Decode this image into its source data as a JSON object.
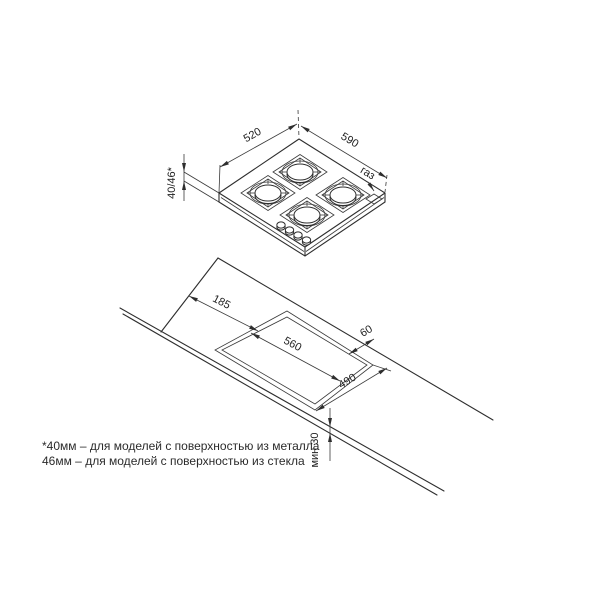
{
  "diagram": {
    "hob": {
      "width_mm": "590",
      "depth_mm": "520",
      "height_mm": "40/46*",
      "gas_label": "газ"
    },
    "cutout": {
      "left_offset_mm": "185",
      "width_mm": "560",
      "depth_mm": "490",
      "rear_gap_mm": "60",
      "front_min_mm": "мин 30"
    },
    "footnote": {
      "line1": "*40мм – для моделей с поверхностью из металла",
      "line2": "46мм – для моделей с поверхностью из стекла"
    }
  }
}
